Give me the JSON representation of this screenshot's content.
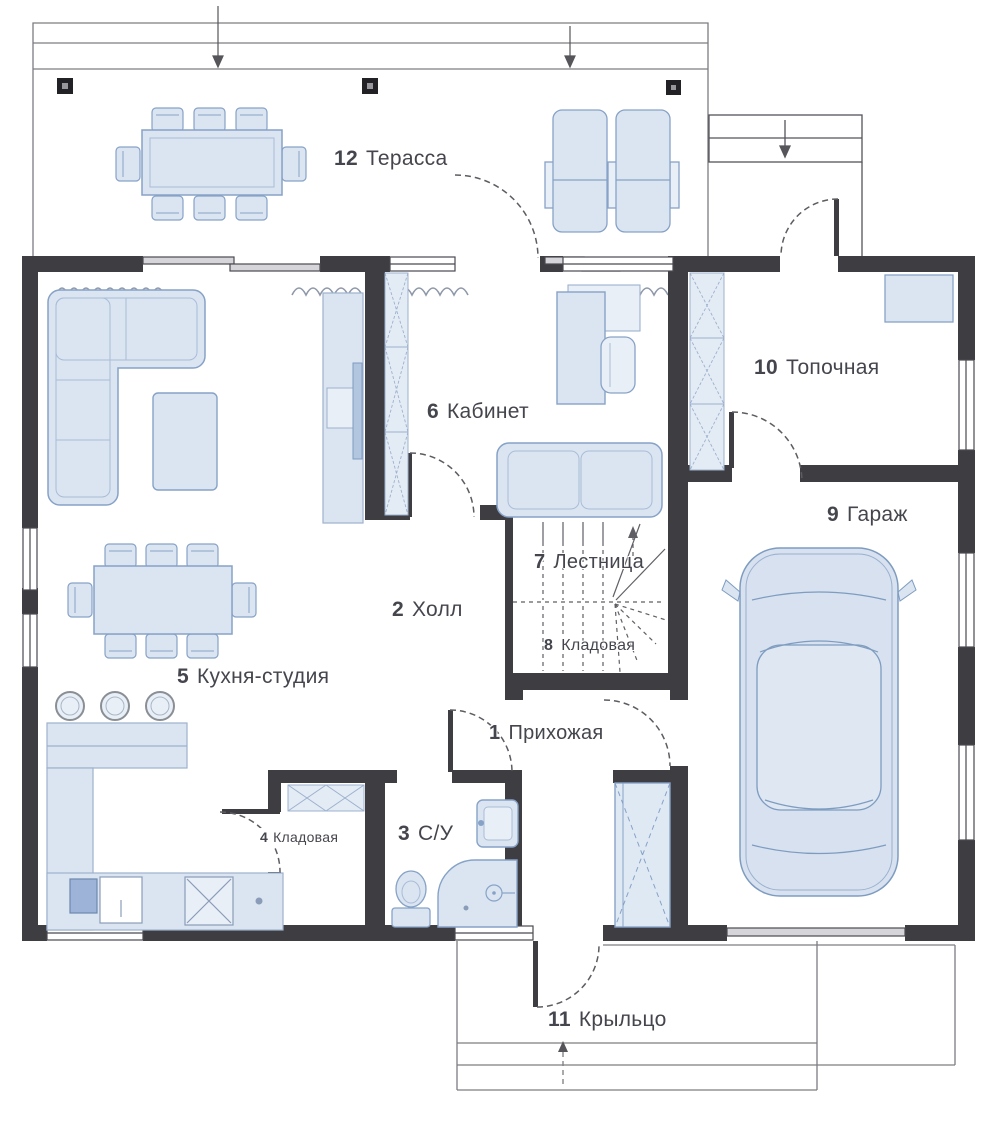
{
  "plan": {
    "rooms": [
      {
        "num": "1",
        "name": "Прихожая"
      },
      {
        "num": "2",
        "name": "Холл"
      },
      {
        "num": "3",
        "name": "С/У"
      },
      {
        "num": "4",
        "name": "Кладовая"
      },
      {
        "num": "5",
        "name": "Кухня-студия"
      },
      {
        "num": "6",
        "name": "Кабинет"
      },
      {
        "num": "7",
        "name": "Лестница"
      },
      {
        "num": "8",
        "name": "Кладовая"
      },
      {
        "num": "9",
        "name": "Гараж"
      },
      {
        "num": "10",
        "name": "Топочная"
      },
      {
        "num": "11",
        "name": "Крыльцо"
      },
      {
        "num": "12",
        "name": "Терасса"
      }
    ],
    "colors": {
      "wall": "#3d3d42",
      "furniture_fill": "#dbe5f1",
      "furniture_stroke": "#87a2c7",
      "text": "#45464d"
    }
  }
}
